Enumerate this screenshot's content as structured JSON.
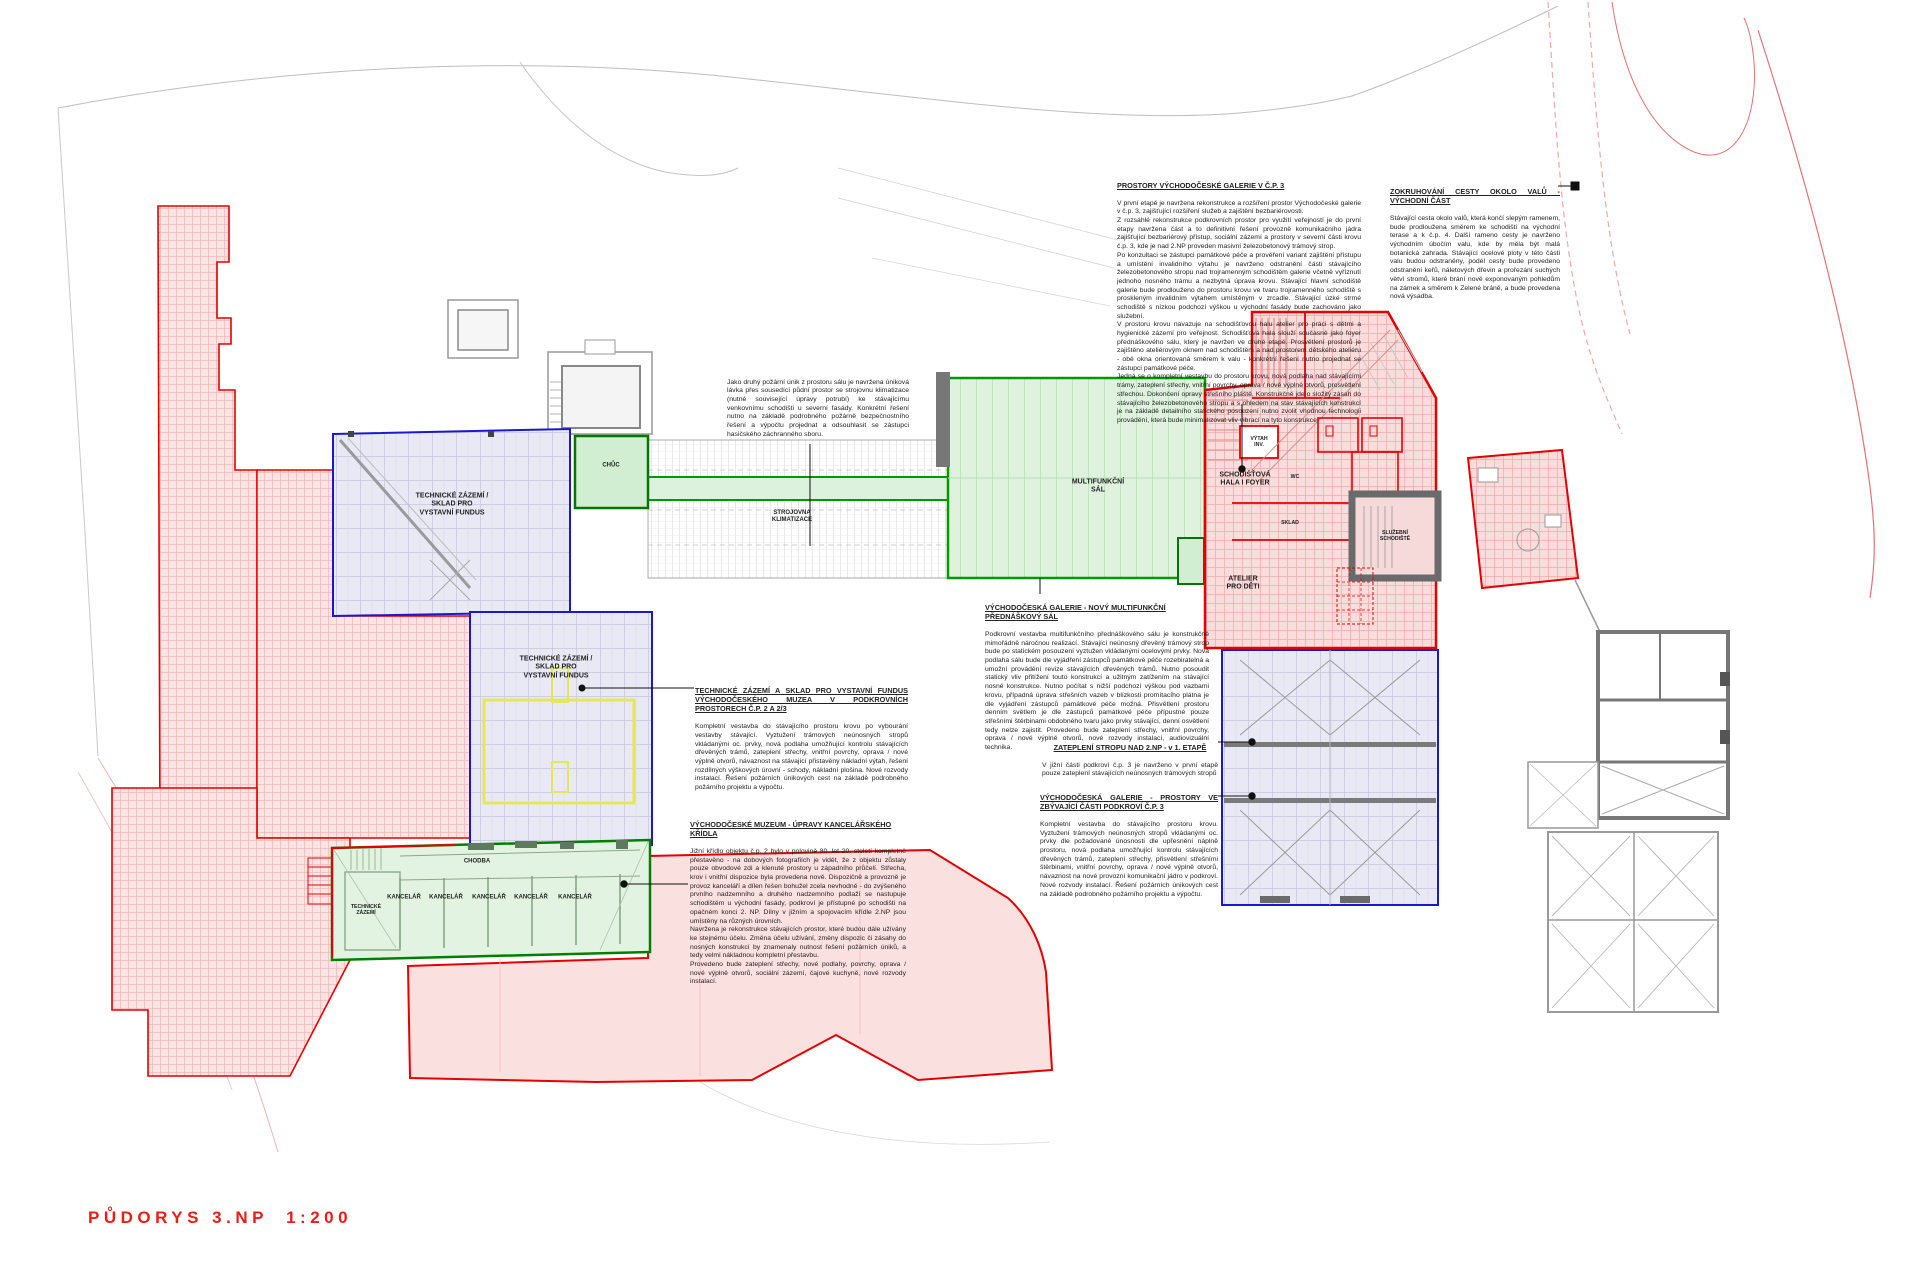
{
  "drawing_title": "PŮDORYS 3.NP  1:200",
  "colors": {
    "red_outline": "#e60000",
    "blue_outline": "#1a1acc",
    "green_outline": "#009900",
    "pink_fill": "#fbe3e3",
    "lavender_fill": "#e9e9f5",
    "green_fill": "#ddf2dd",
    "title_red": "#ed1c16"
  },
  "annotations": {
    "prostory_galerie": {
      "heading": "PROSTORY VÝCHODOČESKÉ GALERIE V Č.P. 3",
      "body": "V první etapě je navržena rekonstrukce a rozšíření prostor Východočeské galerie v č.p. 3, zajišťující rozšíření služeb a zajištění bezbariérovosti.\nZ rozsáhlé rekonstrukce podkrovních prostor pro využití veřejností je do první etapy navržena část a to definitivní řešení provozně komunikačního jádra zajišťující bezbariérový přístup, sociální zázemí a prostory v severní části krovu č.p. 3, kde je nad 2.NP proveden masivní železobetonový trámový strop.\nPo konzultaci se zástupci památkové péče a prověření variant zajištění přístupu a umístění invalidního výtahu je navrženo odstranění části stávajícího železobetonového stropu nad trojramenným schodištěm galerie včetně vyříznutí jednoho nosného trámu a nezbytná úprava krovu. Stávající hlavní schodiště galerie bude prodlouženo do prostoru krovu ve tvaru trojramenného schodiště s proskleným invalidním výtahem umístěným v zrcadle. Stávající úzké strmé schodiště s nízkou podchozí výškou u východní fasády bude zachováno jako služební.\nV prostoru krovu navazuje na schodišťovou halu atelier pro práci s dětmi a hygienické zázemí pro veřejnost. Schodišťová hala slouží současně jako foyer přednáškového sálu, který je navržen ve druhé etapě. Prosvětlení prostorů je zajištěno ateliérovým oknem nad schodištěm a nad prostorem dětského ateliéru - obě okna orientovaná směrem k valu - konkrétní řešení nutno projednat se zástupci památkové péče.\nJedná se o kompletní vestavbu do prostoru krovu, nová podlaha nad stávajícími trámy, zateplení střechy, vnitřní povrchy, oprava / nové výplně otvorů, prosvětlení střechou. Dokončení opravy střešního pláště. Konstrukčně jde o složitý zásah do stávajícího železobetonového stropu a s ohledem na stav stávajících konstrukcí je na základě detailního statického posouzení nutno zvolit vhodnou technologii provádění, která bude minimalizovat vliv vibrací na tyto konstrukce."
    },
    "zokruhovani_cesty": {
      "heading": "ZOKRUHOVÁNÍ CESTY OKOLO VALŮ - VÝCHODNÍ ČÁST",
      "body": "Stávající cesta okolo valů, která končí slepým ramenem, bude prodloužena směrem ke schodišti na východní terase a k č.p. 4. Další rameno cesty je navrženo východním úbočím valu, kde by měla být malá botanická zahrada. Stávající ocelové ploty v této části valu budou odstraněny, podél cesty bude provedeno odstranění keřů, náletových dřevin a prořezání suchých větví stromů, které brání nově exponovaným pohledům na zámek a směrem k Zelené bráně, a bude provedena nová výsadba."
    },
    "pozarni_unik": {
      "body": "Jako druhý požární únik z prostoru sálu je navržena úniková lávka přes sousedící půdní prostor se strojovnu klimatizace (nutné související úpravy potrubí) ke stávajícímu venkovnímu schodišti u severní fasády. Konkrétní řešení nutno na základě podrobného požárně bezpečnostního řešení a výpočtu projednat a odsouhlasit se zástupci hasičského záchranného sboru."
    },
    "novy_prednaskovy_sal": {
      "heading": "VÝCHODOČESKÁ GALERIE - NOVÝ MULTIFUNKČNÍ PŘEDNÁŠKOVÝ SÁL",
      "body": "Podkrovní vestavba multifunkčního přednáškového sálu je konstrukčně mimořádně náročnou realizací. Stávající neúnosný dřevěný trámový strop bude po statickém posouzení vyztužen vkládanými ocelovými prvky. Nová podlaha sálu bude dle vyjádření zástupců památkové péče rozebiratelná a umožní provádění revize stávajících dřevěných trámů. Nutno posoudit statický vliv přitížení touto konstrukcí a užitným zatížením na stávající nosné konstrukce. Nutno počítat s nižší podchozí výškou pod vazbami krovu, případná úprava střešních vazeb v blízkosti promítacího plátna je dle vyjádření zástupců památkové péče možná. Přisvětlení prostoru denním světlem je dle zástupců památkové péče přípustné pouze střešními štěrbinami obdobného tvaru jako prvky stávající, denní osvětlení tedy nelze zajistit. Provedeno bude zateplení střechy, vnitřní povrchy, oprava / nové výplně otvorů, nové rozvody instalací, audiovizuální technika."
    },
    "technicke_zazemi_sklad": {
      "heading": "TECHNICKÉ ZÁZEMÍ A SKLAD PRO VYSTAVNÍ FUNDUS VÝCHODOČESKÉHO MUZEA V PODKROVNÍCH PROSTORECH Č.P. 2 A 2/3",
      "body": "Kompletní vestavba do stávajícího prostoru krovu po vybourání vestavby stávající. Vyztužení trámových neúnosných stropů vkládanými oc. prvky, nová podlaha umožňující kontrolu stávajících dřevěných trámů, zateplení střechy, vnitřní povrchy, oprava / nové výplně otvorů, návaznost na stávající přistavěný nákladní výtah, řešení rozdílných výškových úrovní - schody, nákladní plošina. Nové rozvody instalací. Řešení požárních únikových cest na základě podrobného požárního projektu a výpočtu."
    },
    "upravy_kancelarskeho_kridla": {
      "heading": "VÝCHODOČESKÉ MUZEUM - ÚPRAVY KANCELÁŘSKÉHO KŘÍDLA",
      "body": "Jižní křídlo objektu č.p. 2 bylo v polovině 80. let 20. století kompletně přestavěno - na dobových fotografiích je vidět, že z objektu zůstaly pouze obvodové zdi a klenuté prostory u západního průčelí. Střecha, krov i vnitřní dispozice byla provedena nově. Dispozičně a provozně je provoz kanceláří a dílen řešen bohužel zcela nevhodně - do zvýšeného prvního nadzemního a druhého nadzemního podlaží se nastupuje schodištěm u východní fasády, podkroví je přístupné po schodišti na opačném konci 2. NP. Dílny v jižním a spojovacím křídle 2.NP jsou umístěny na různých úrovních.\nNavržena je rekonstrukce stávajících prostor, které budou dále užívány ke stejnému účelu. Změna účelu užívání, změny dispozic či zásahy do nosných konstrukcí by znamenaly nutnost řešení požárních úniků, a tedy velmi nákladnou kompletní přestavbu.\nProvedeno bude zateplení střechy, nové podlahy, povrchy, oprava / nové výplně otvorů, sociální zázemí, čajové kuchyně, nové rozvody instalací."
    },
    "zatepleni_stropu": {
      "heading": "ZATEPLENÍ STROPU NAD 2.NP - v 1. ETAPĚ",
      "body": "V jižní části podkroví č.p. 3 je navrženo v první etapě pouze zateplení stávajících neúnosných trámových stropů"
    },
    "prostory_podkrovi": {
      "heading": "VÝCHODOČESKÁ GALERIE - PROSTORY VE ZBÝVAJÍCÍ ČÁSTI PODKROVÍ Č.P. 3",
      "body": "Kompletní vestavba do stávajícího prostoru krovu. Vyztužení trámových neúnosných stropů vkládanými oc. prvky dle požadované únosnosti dle upřesnění náplně prostoru, nová podlaha umožňující kontrolu stávajících dřevěných trámů, zateplení střechy, přisvětlení střešními štěrbinami, vnitřní povrchy, oprava / nové výplně otvorů, návaznost na nové provozní komunikační jádro v podkroví. Nové rozvody instalací. Řešení požárních únikových cest na základě podrobného požárního projektu a výpočtu."
    }
  },
  "room_labels": {
    "technicke_zazemi_fundus": "TECHNICKÉ ZÁZEMÍ /\nSKLAD PRO\nVYSTAVNÍ FUNDUS",
    "strojovna": "STROJOVNA\nKLIMATIZACE",
    "chuc": "CHŮC",
    "multifunkcni_sal": "MULTIFUNKČNÍ\nSÁL",
    "schodistova_hala": "SCHODIŠŤOVÁ\nHALA I FOYER",
    "vytah_inv": "VÝTAH\nINV.",
    "wc": "WC",
    "sklad": "SKLAD",
    "sluzebni_schodiste": "SLUŽEBNÍ\nSCHODIŠTĚ",
    "atelier_pro_deti": "ATELIER\nPRO DĚTI",
    "chodba": "CHODBA",
    "kancelar": "KANCELÁŘ",
    "technicke_zazemi": "TECHNICKÉ\nZÁZEMÍ"
  }
}
